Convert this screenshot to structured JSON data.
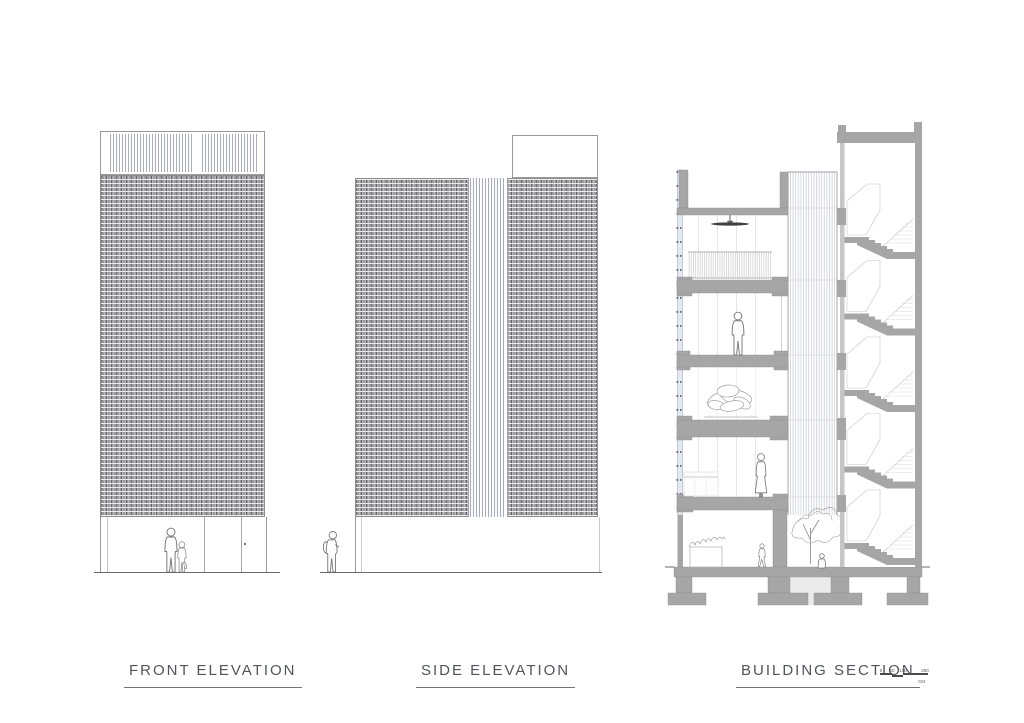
{
  "sheet": {
    "background": "#ffffff"
  },
  "labels": {
    "front_elevation": "FRONT ELEVATION",
    "side_elevation": "SIDE ELEVATION",
    "building_section": "BUILDING SECTION"
  },
  "scale_bar": {
    "ticks": [
      "0",
      "50",
      "100",
      "200"
    ],
    "unit": "CM"
  },
  "colors": {
    "brick_gray": "#9a9a9c",
    "poche_gray": "#a6a6a6",
    "screen_blue_gray": "#e4e8f1",
    "line_gray": "#8a8a8a",
    "label_text": "#50555c",
    "ground_line": "#6b6b6b"
  }
}
